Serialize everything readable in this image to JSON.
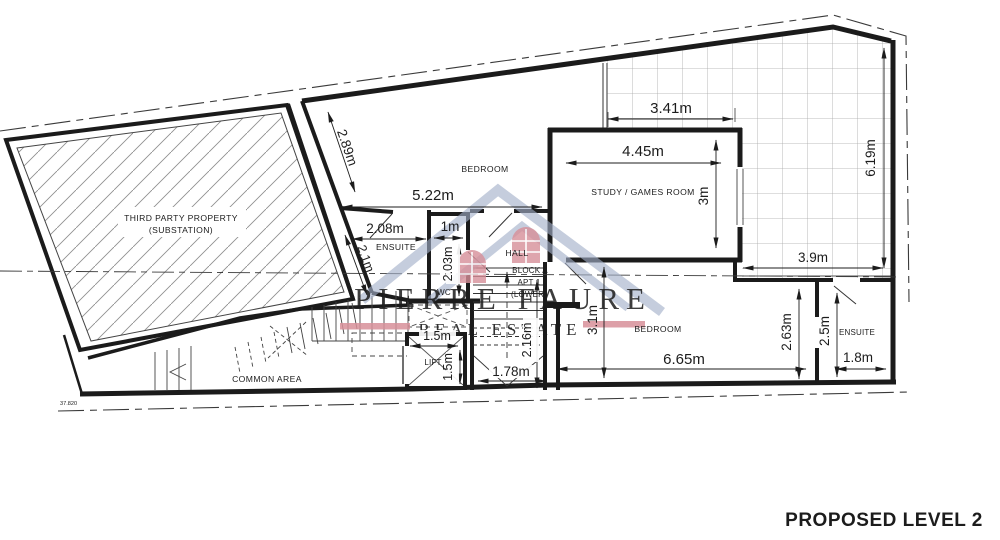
{
  "plan": {
    "title": "PROPOSED LEVEL 2",
    "level_marker": "37.820"
  },
  "watermark": {
    "name": "PIERRE FAURE",
    "tagline": "REAL ESTATE"
  },
  "colors": {
    "watermark_blue": "#a3b0c9",
    "watermark_pink": "#d78f99",
    "wall": "#1b1b1b"
  },
  "rooms": {
    "substation_line1": "THIRD PARTY PROPERTY",
    "substation_line2": "(SUBSTATION)",
    "bedroom_upper": "BEDROOM",
    "study": "STUDY / GAMES ROOM",
    "ensuite_left": "ENSUITE",
    "wc": "WC",
    "hall": "HALL",
    "block_line1": "BLOCK A",
    "block_line2": "APT 1",
    "block_line3": "(LOWER)",
    "common_area": "COMMON AREA",
    "lift": "LIFT",
    "bedroom_lower": "BEDROOM",
    "ensuite_right": "ENSUITE"
  },
  "dimensions": {
    "bedroom_upper_depth": "2.89m",
    "bedroom_upper_width": "5.22m",
    "ensuite_left_width": "2.08m",
    "ensuite_left_depth": "2.1m",
    "wc_width": "1m",
    "wc_depth": "2.03m",
    "terrace_top_width": "3.41m",
    "study_width": "4.45m",
    "study_depth": "3m",
    "terrace_height": "6.19m",
    "terrace_bottom_width": "3.9m",
    "lift_width": "1.5m",
    "lift_depth": "1.5m",
    "stair_depth": "2.16m",
    "stair_width": "1.78m",
    "bedroom_lower_depth": "3.1m",
    "bedroom_lower_width": "6.65m",
    "bedroom_lower_right_depth": "2.63m",
    "ensuite_right_depth": "2.5m",
    "ensuite_right_width": "1.8m"
  }
}
